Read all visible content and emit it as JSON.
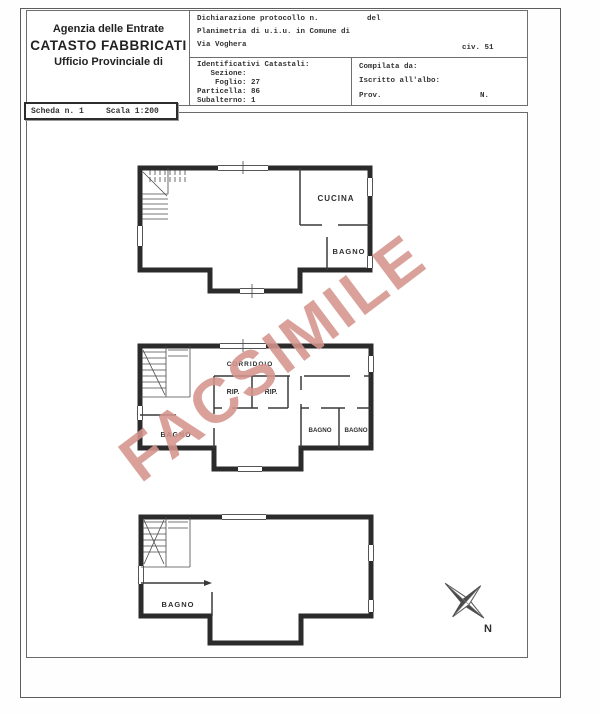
{
  "header": {
    "agency": {
      "line1": "Agenzia delle Entrate",
      "line2": "CATASTO FABBRICATI",
      "line3": "Ufficio Provinciale di"
    },
    "declaration": {
      "line1_left": "Dichiarazione protocollo n.",
      "line1_right": "del",
      "line2": "Planimetria di u.i.u. in Comune di",
      "line3_left": "Via Voghera",
      "line3_right": "civ. 51"
    },
    "cadastral": {
      "title": "Identificativi Catastali:",
      "row_sezione": "   Sezione:",
      "row_foglio": "    Foglio: 27",
      "row_particella": "Particella: 86",
      "row_subalterno": "Subalterno: 1"
    },
    "compiler": {
      "line1": "Compilata da:",
      "line2": "Iscritto all'albo:",
      "line3_left": "Prov.",
      "line3_right": "N."
    },
    "sheet": {
      "number_label": "Scheda n. 1",
      "scale_label": "Scala 1:200"
    }
  },
  "plans": {
    "terra": {
      "title1": "ABITAZIONE",
      "title2": "PIANO TERRA",
      "height_label": "h. = 3.00 m.",
      "rooms": {
        "cucina": "CUCINA",
        "bagno": "BAGNO"
      }
    },
    "primo": {
      "title2": "PIANO PRIMO",
      "height_label": "h. = 3.00 m.",
      "rooms": {
        "corridoio": "CORRIDOIO",
        "rip1": "RIP.",
        "rip2": "RIP.",
        "bagno1": "BAGNO",
        "bagno2": "BAGNO",
        "bagno3": "BAGNO"
      }
    },
    "s1": {
      "title2": "PIANO S1",
      "height_label": "h. = 3.00 m.",
      "rooms": {
        "bagno": "BAGNO"
      }
    }
  },
  "compass": {
    "label": "N"
  },
  "watermark": {
    "text": "FACSIMILE",
    "color": "#d6958e"
  },
  "colors": {
    "wall": "#2b2b2b",
    "border": "#6e6e6e"
  }
}
